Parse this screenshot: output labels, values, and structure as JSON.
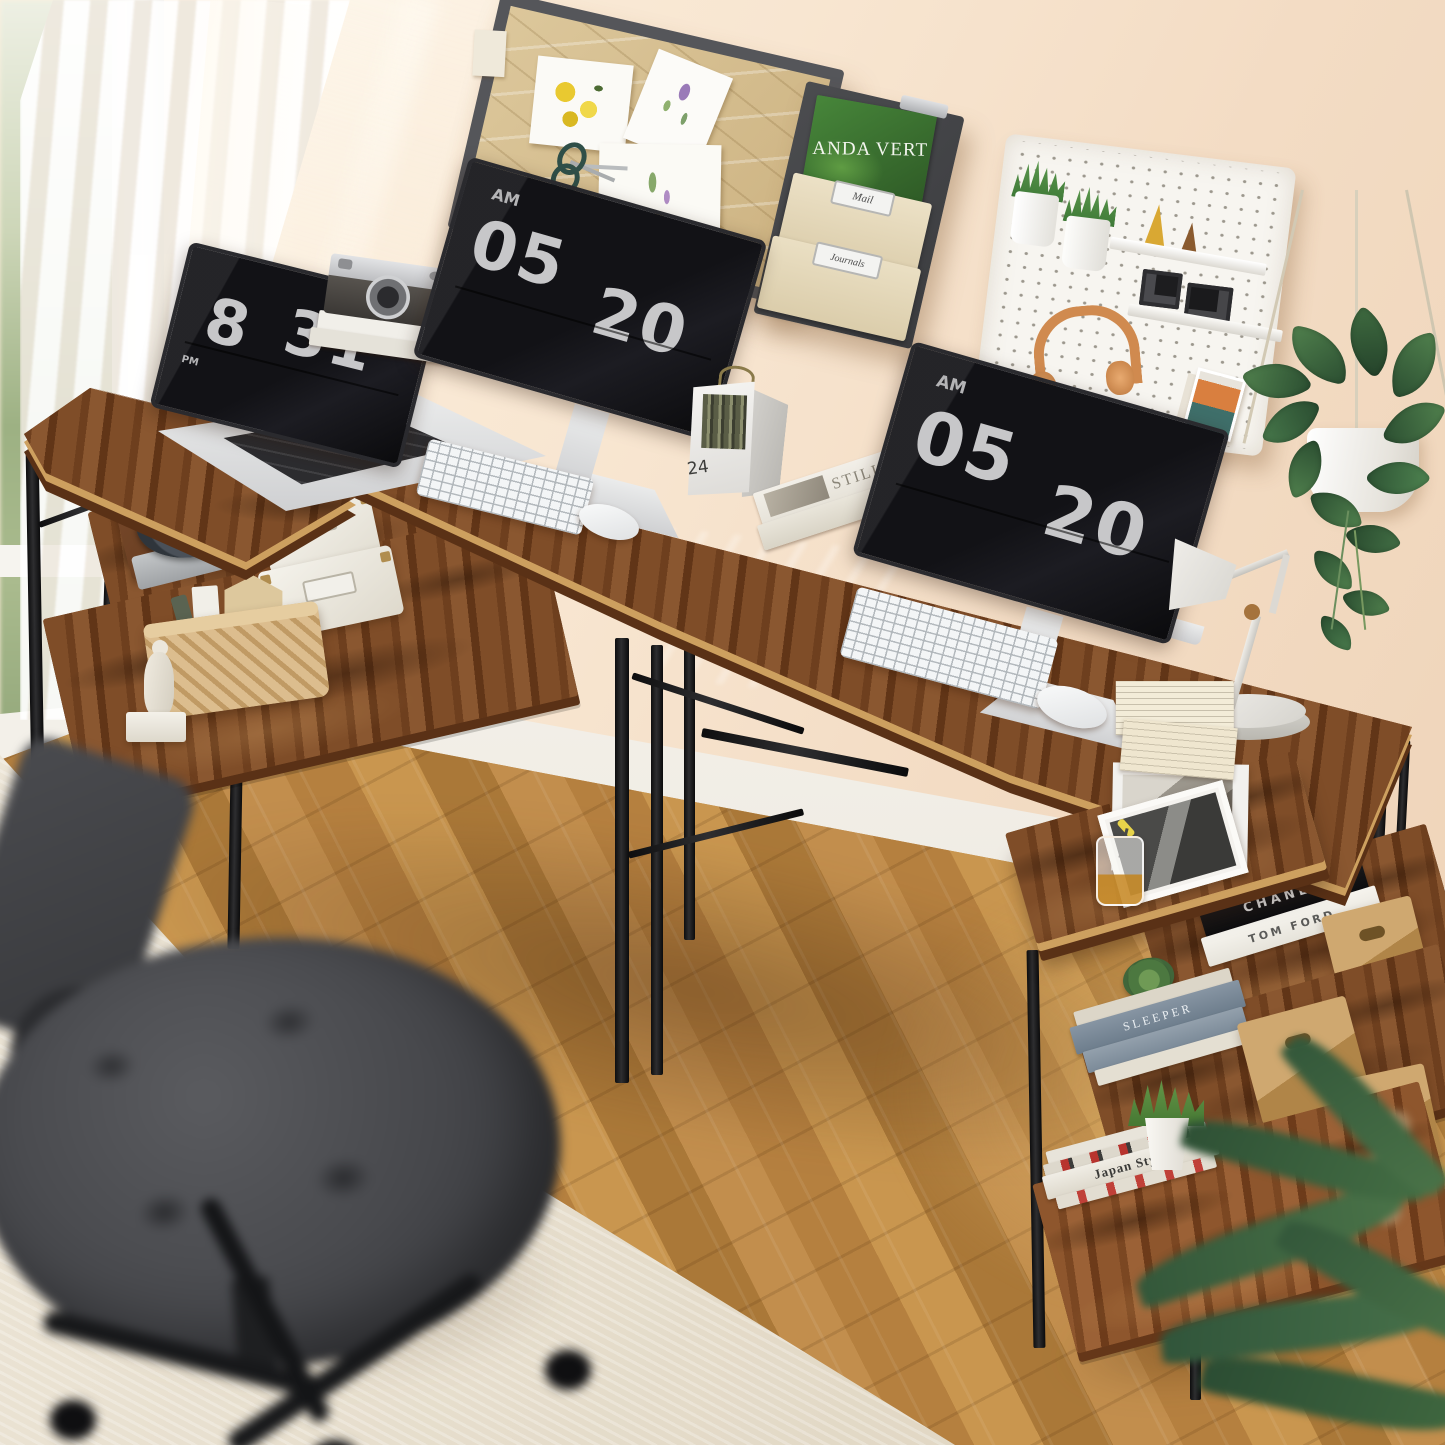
{
  "clocks": {
    "laptop": {
      "meridiem": "PM",
      "hh": "8",
      "mm": "31"
    },
    "left_monitor": {
      "meridiem": "AM",
      "hh": "05",
      "mm": "20"
    },
    "right_monitor": {
      "meridiem": "AM",
      "hh": "05",
      "mm": "20"
    }
  },
  "calendar": {
    "day": "24"
  },
  "wall_organizer": {
    "magazine_title": "ANDA VERT",
    "labels": [
      "Mail",
      "Journals"
    ]
  },
  "book_spines": {
    "desk_magazine": "STILL",
    "black_book": "CHANEL",
    "white_book": "TOM FORD",
    "blue_book": "SLEEPER",
    "magazine_stack": "Japan Style"
  },
  "colors": {
    "wall": "#f5e0cb",
    "desk_wood": "#7a4826",
    "desk_edge": "#cda05f",
    "metal_frame": "#151515",
    "floor": "#bd8845",
    "rug": "#e9e1d1",
    "pegboard": "#f6f4ef",
    "clock_digits": "#c7c7c9",
    "headphones": "#d08a4f",
    "magazine_green": "#3f7a33"
  }
}
